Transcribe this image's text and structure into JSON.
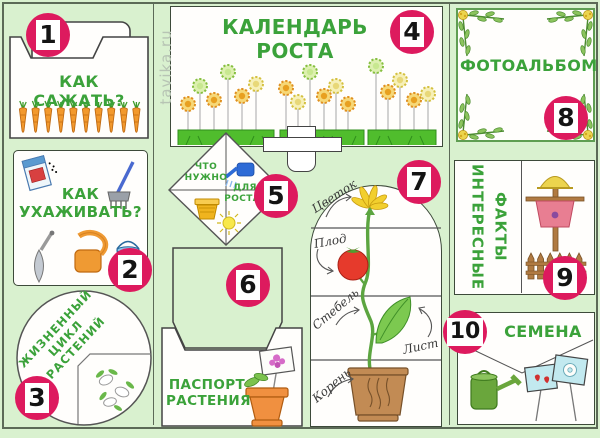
{
  "poster": {
    "watermark": "tavika.ru",
    "colors": {
      "background": "#d9f1cf",
      "badge_pink": "#dd1a5e",
      "heading_green": "#3ba23a"
    },
    "panels": {
      "how_to_plant": {
        "number": "1",
        "title": "КАК САЖАТЬ?"
      },
      "how_to_care": {
        "number": "2",
        "title": "КАК\nУХАЖИВАТЬ?"
      },
      "life_cycle": {
        "number": "3",
        "title": "ЖИЗНЕННЫЙ\nЦИКЛ\nРАСТЕНИЙ"
      },
      "growth_calendar": {
        "number": "4",
        "title": "КАЛЕНДАРЬ РОСТА"
      },
      "what_is_needed": {
        "number": "5",
        "text_top": "ЧТО\nНУЖНО",
        "text_bottom": "ДЛЯ\nРОСТА?"
      },
      "plant_passport": {
        "number": "6",
        "title": "ПАСПОРТ\nРАСТЕНИЯ"
      },
      "plant_parts": {
        "number": "7",
        "labels": {
          "flower": "Цветок",
          "fruit": "Плод",
          "stem": "Стебель",
          "leaf": "Лист",
          "root": "Корень"
        }
      },
      "photo_album": {
        "number": "8",
        "title": "ФОТОАЛЬБОМ"
      },
      "fun_facts": {
        "number": "9",
        "col_left": "ИНТЕРЕСНЫЕ",
        "col_right": "ФАКТЫ"
      },
      "seeds": {
        "number": "10",
        "title": "СЕМЕНА"
      }
    }
  }
}
